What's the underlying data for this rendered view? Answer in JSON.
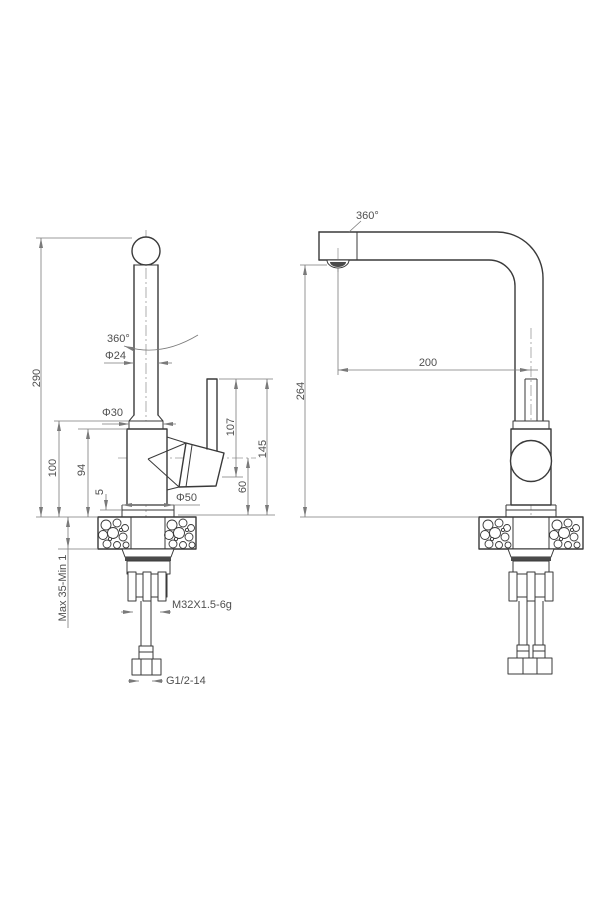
{
  "drawing_type": "faucet-installation-dimension-drawing",
  "front_view": {
    "dims": {
      "spout_height": "290",
      "body_top_to_deck": "100",
      "body_height": "94",
      "base_step": "5",
      "deck_range": "Max 35-Min 1",
      "spout_tube_diameter": "Φ24",
      "column_diameter": "Φ30",
      "base_diameter": "Φ50",
      "swivel_angle": "360°",
      "handle_height": "107",
      "handle_top_height": "145",
      "handle_axis_height": "60",
      "mounting_thread": "M32X1.5-6g",
      "inlet_thread": "G1/2-14"
    }
  },
  "side_view": {
    "dims": {
      "swivel_angle": "360°",
      "spout_reach": "200",
      "outlet_height": "264"
    }
  },
  "colors": {
    "outline": "#3a3a3a",
    "dimension": "#7a7a7a",
    "text": "#4f4f4f",
    "fill_dark": "#4a4a4a",
    "background": "#ffffff"
  }
}
